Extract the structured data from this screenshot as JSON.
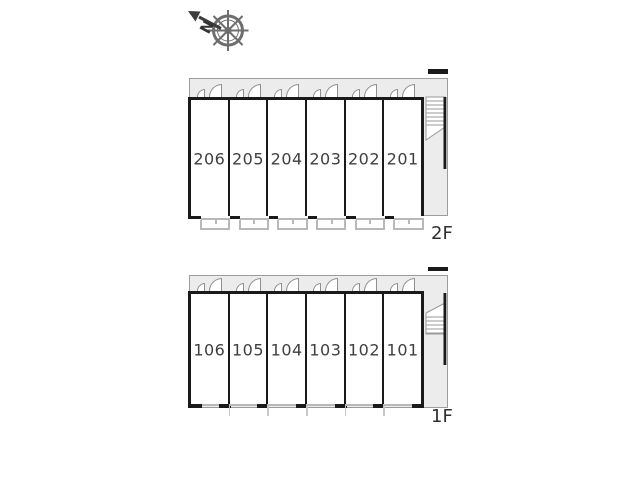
{
  "compass": {
    "north_label": "N"
  },
  "floors": [
    {
      "label": "2F",
      "rooms": [
        "206",
        "205",
        "204",
        "203",
        "202",
        "201"
      ]
    },
    {
      "label": "1F",
      "rooms": [
        "106",
        "105",
        "104",
        "103",
        "102",
        "101"
      ]
    }
  ],
  "colors": {
    "wall": "#1a1a1a",
    "corridor": "#ececec",
    "outline": "#9c9c9c",
    "door": "#8f8f8f",
    "balc": "#b8b8b8",
    "num": "#3f3f3f",
    "label": "#2f2f2f",
    "compass": "#6e6e6e",
    "arrow": "#3c3c3c"
  }
}
